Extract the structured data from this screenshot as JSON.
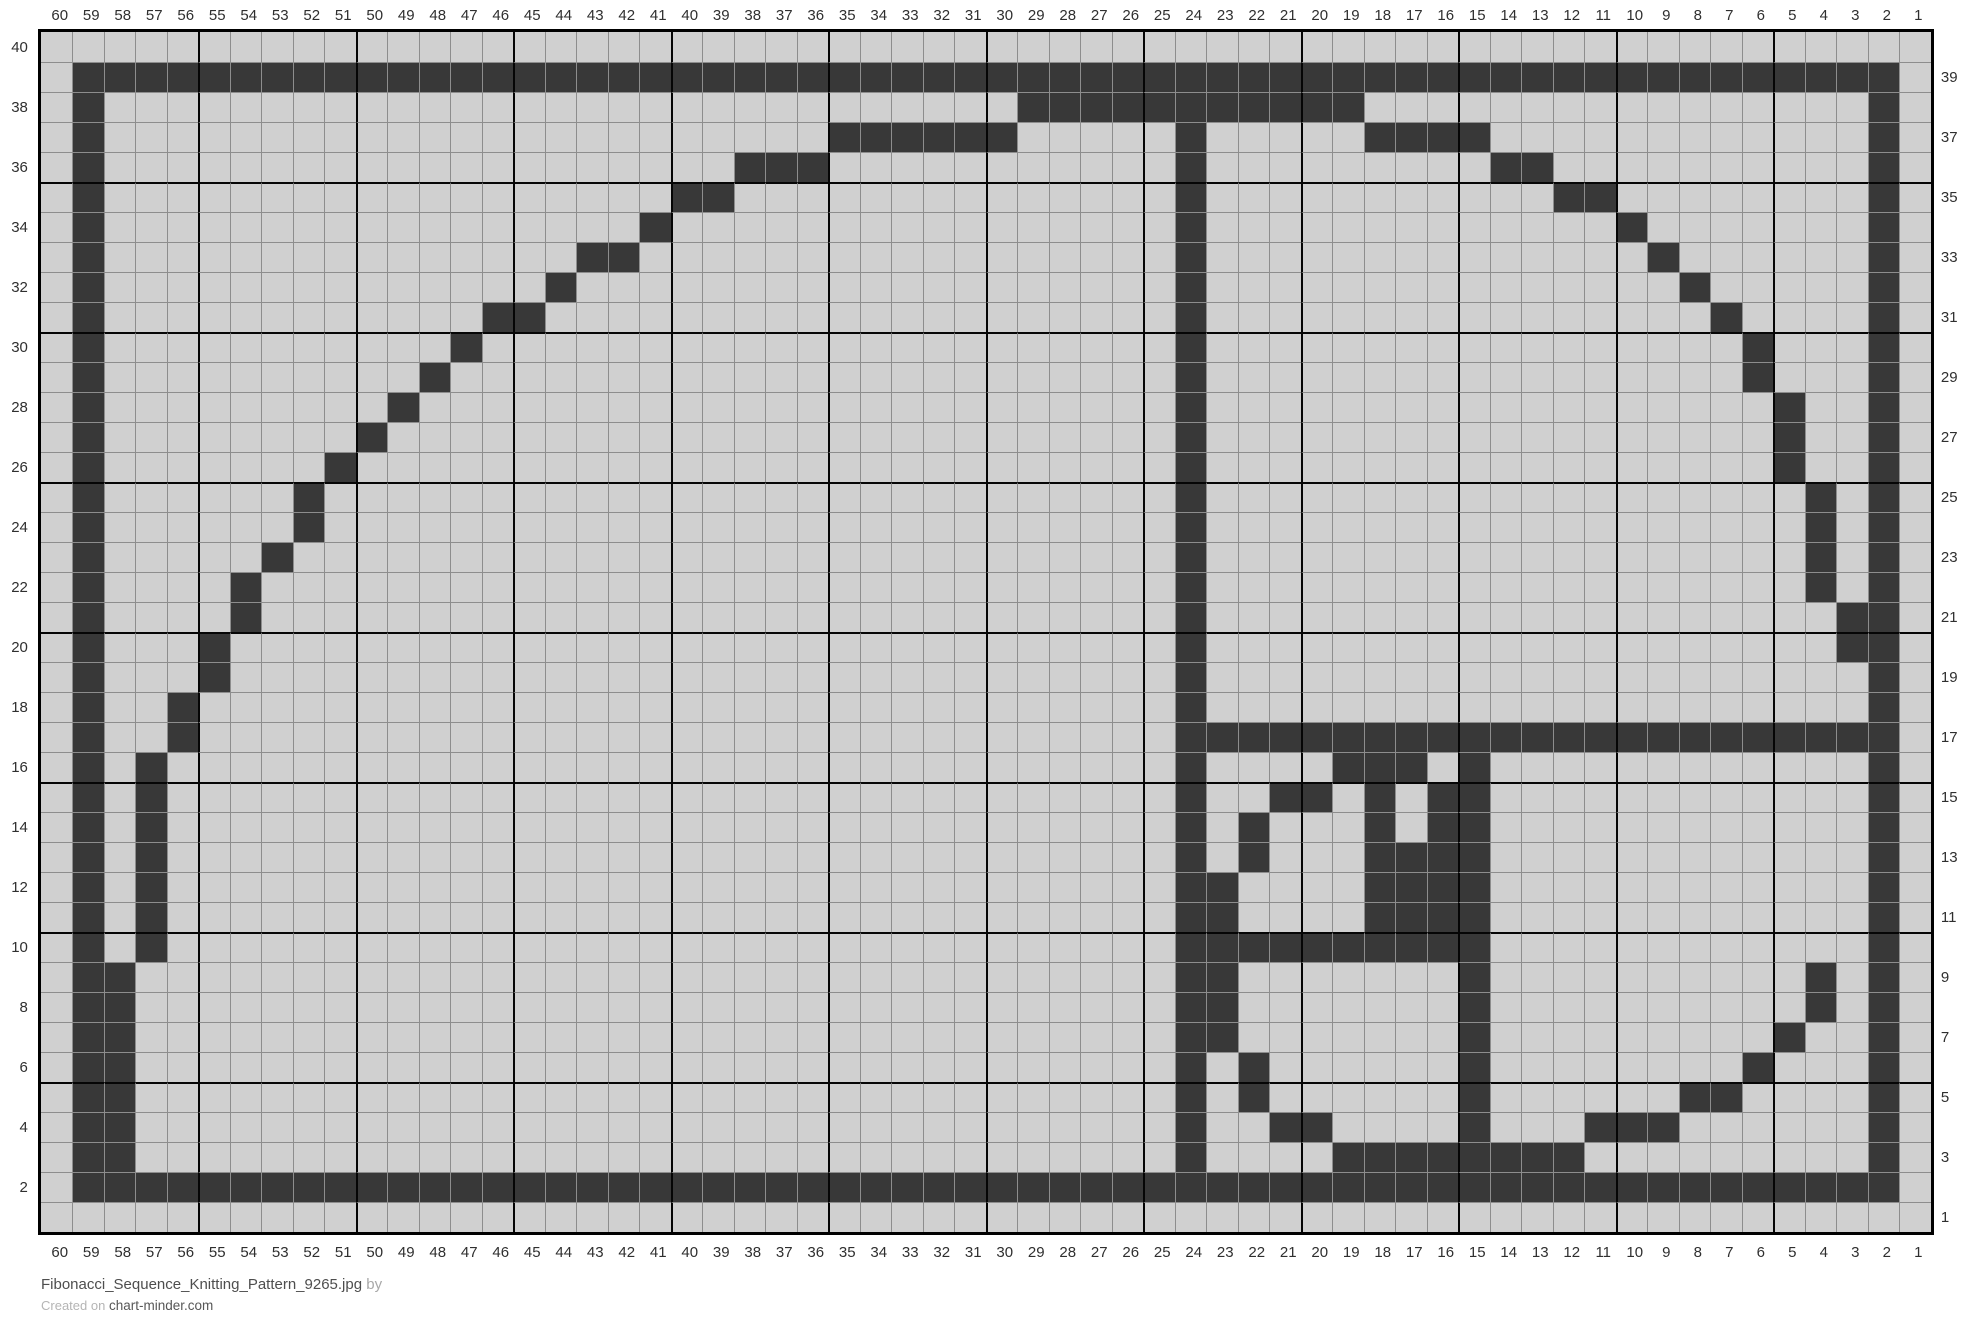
{
  "chart_data": {
    "type": "heatmap",
    "title": "Fibonacci golden-spiral knitting chart grid",
    "columns": 60,
    "rows_count": 40,
    "bold_line_every": 5,
    "legend": {
      "dark": "dark stitch",
      "light": "background stitch"
    },
    "colors": {
      "dark_cell": "#383838",
      "light_cell": "#d0d0d0",
      "thin_grid_line": "#8d8d8d",
      "bold_grid_line": "#050505",
      "outer_border": "#000000",
      "label_text": "#2f2f2f"
    },
    "top_labels": [
      60,
      59,
      58,
      57,
      56,
      55,
      54,
      53,
      52,
      51,
      50,
      49,
      48,
      47,
      46,
      45,
      44,
      43,
      42,
      41,
      40,
      39,
      38,
      37,
      36,
      35,
      34,
      33,
      32,
      31,
      30,
      29,
      28,
      27,
      26,
      25,
      24,
      23,
      22,
      21,
      20,
      19,
      18,
      17,
      16,
      15,
      14,
      13,
      12,
      11,
      10,
      9,
      8,
      7,
      6,
      5,
      4,
      3,
      2,
      1
    ],
    "bottom_labels": [
      60,
      59,
      58,
      57,
      56,
      55,
      54,
      53,
      52,
      51,
      50,
      49,
      48,
      47,
      46,
      45,
      44,
      43,
      42,
      41,
      40,
      39,
      38,
      37,
      36,
      35,
      34,
      33,
      32,
      31,
      30,
      29,
      28,
      27,
      26,
      25,
      24,
      23,
      22,
      21,
      20,
      19,
      18,
      17,
      16,
      15,
      14,
      13,
      12,
      11,
      10,
      9,
      8,
      7,
      6,
      5,
      4,
      3,
      2,
      1
    ],
    "left_labels": [
      40,
      38,
      36,
      34,
      32,
      30,
      28,
      26,
      24,
      22,
      20,
      18,
      16,
      14,
      12,
      10,
      8,
      6,
      4,
      2
    ],
    "right_labels": [
      39,
      37,
      35,
      33,
      31,
      29,
      27,
      25,
      23,
      21,
      19,
      17,
      15,
      13,
      11,
      9,
      7,
      5,
      3,
      1
    ],
    "rows": [
      {
        "row": 40,
        "dark": []
      },
      {
        "row": 39,
        "dark": [
          [
            59,
            2
          ]
        ]
      },
      {
        "row": 38,
        "dark": [
          [
            59,
            59
          ],
          [
            29,
            19
          ],
          [
            2,
            2
          ]
        ]
      },
      {
        "row": 37,
        "dark": [
          [
            59,
            59
          ],
          [
            35,
            30
          ],
          [
            24,
            24
          ],
          [
            18,
            15
          ],
          [
            2,
            2
          ]
        ]
      },
      {
        "row": 36,
        "dark": [
          [
            59,
            59
          ],
          [
            38,
            36
          ],
          [
            24,
            24
          ],
          [
            14,
            13
          ],
          [
            2,
            2
          ]
        ]
      },
      {
        "row": 35,
        "dark": [
          [
            59,
            59
          ],
          [
            40,
            39
          ],
          [
            24,
            24
          ],
          [
            12,
            11
          ],
          [
            2,
            2
          ]
        ]
      },
      {
        "row": 34,
        "dark": [
          [
            59,
            59
          ],
          [
            41,
            41
          ],
          [
            24,
            24
          ],
          [
            10,
            10
          ],
          [
            2,
            2
          ]
        ]
      },
      {
        "row": 33,
        "dark": [
          [
            59,
            59
          ],
          [
            43,
            42
          ],
          [
            24,
            24
          ],
          [
            9,
            9
          ],
          [
            2,
            2
          ]
        ]
      },
      {
        "row": 32,
        "dark": [
          [
            59,
            59
          ],
          [
            44,
            44
          ],
          [
            24,
            24
          ],
          [
            8,
            8
          ],
          [
            2,
            2
          ]
        ]
      },
      {
        "row": 31,
        "dark": [
          [
            59,
            59
          ],
          [
            46,
            45
          ],
          [
            24,
            24
          ],
          [
            7,
            7
          ],
          [
            2,
            2
          ]
        ]
      },
      {
        "row": 30,
        "dark": [
          [
            59,
            59
          ],
          [
            47,
            47
          ],
          [
            24,
            24
          ],
          [
            6,
            6
          ],
          [
            2,
            2
          ]
        ]
      },
      {
        "row": 29,
        "dark": [
          [
            59,
            59
          ],
          [
            48,
            48
          ],
          [
            24,
            24
          ],
          [
            6,
            6
          ],
          [
            2,
            2
          ]
        ]
      },
      {
        "row": 28,
        "dark": [
          [
            59,
            59
          ],
          [
            49,
            49
          ],
          [
            24,
            24
          ],
          [
            5,
            5
          ],
          [
            2,
            2
          ]
        ]
      },
      {
        "row": 27,
        "dark": [
          [
            59,
            59
          ],
          [
            50,
            50
          ],
          [
            24,
            24
          ],
          [
            5,
            5
          ],
          [
            2,
            2
          ]
        ]
      },
      {
        "row": 26,
        "dark": [
          [
            59,
            59
          ],
          [
            51,
            51
          ],
          [
            24,
            24
          ],
          [
            5,
            5
          ],
          [
            2,
            2
          ]
        ]
      },
      {
        "row": 25,
        "dark": [
          [
            59,
            59
          ],
          [
            52,
            52
          ],
          [
            24,
            24
          ],
          [
            4,
            4
          ],
          [
            2,
            2
          ]
        ]
      },
      {
        "row": 24,
        "dark": [
          [
            59,
            59
          ],
          [
            52,
            52
          ],
          [
            24,
            24
          ],
          [
            4,
            4
          ],
          [
            2,
            2
          ]
        ]
      },
      {
        "row": 23,
        "dark": [
          [
            59,
            59
          ],
          [
            53,
            53
          ],
          [
            24,
            24
          ],
          [
            4,
            4
          ],
          [
            2,
            2
          ]
        ]
      },
      {
        "row": 22,
        "dark": [
          [
            59,
            59
          ],
          [
            54,
            54
          ],
          [
            24,
            24
          ],
          [
            4,
            4
          ],
          [
            2,
            2
          ]
        ]
      },
      {
        "row": 21,
        "dark": [
          [
            59,
            59
          ],
          [
            54,
            54
          ],
          [
            24,
            24
          ],
          [
            3,
            2
          ]
        ]
      },
      {
        "row": 20,
        "dark": [
          [
            59,
            59
          ],
          [
            55,
            55
          ],
          [
            24,
            24
          ],
          [
            3,
            2
          ]
        ]
      },
      {
        "row": 19,
        "dark": [
          [
            59,
            59
          ],
          [
            55,
            55
          ],
          [
            24,
            24
          ],
          [
            2,
            2
          ]
        ]
      },
      {
        "row": 18,
        "dark": [
          [
            59,
            59
          ],
          [
            56,
            56
          ],
          [
            24,
            24
          ],
          [
            2,
            2
          ]
        ]
      },
      {
        "row": 17,
        "dark": [
          [
            59,
            59
          ],
          [
            56,
            56
          ],
          [
            24,
            2
          ]
        ]
      },
      {
        "row": 16,
        "dark": [
          [
            59,
            59
          ],
          [
            57,
            57
          ],
          [
            24,
            24
          ],
          [
            19,
            17
          ],
          [
            15,
            15
          ],
          [
            2,
            2
          ]
        ]
      },
      {
        "row": 15,
        "dark": [
          [
            59,
            59
          ],
          [
            57,
            57
          ],
          [
            24,
            24
          ],
          [
            21,
            20
          ],
          [
            18,
            18
          ],
          [
            16,
            15
          ],
          [
            2,
            2
          ]
        ]
      },
      {
        "row": 14,
        "dark": [
          [
            59,
            59
          ],
          [
            57,
            57
          ],
          [
            24,
            24
          ],
          [
            22,
            22
          ],
          [
            18,
            18
          ],
          [
            16,
            15
          ],
          [
            2,
            2
          ]
        ]
      },
      {
        "row": 13,
        "dark": [
          [
            59,
            59
          ],
          [
            57,
            57
          ],
          [
            24,
            24
          ],
          [
            22,
            22
          ],
          [
            18,
            15
          ],
          [
            2,
            2
          ]
        ]
      },
      {
        "row": 12,
        "dark": [
          [
            59,
            59
          ],
          [
            57,
            57
          ],
          [
            24,
            24
          ],
          [
            23,
            23
          ],
          [
            18,
            15
          ],
          [
            2,
            2
          ]
        ]
      },
      {
        "row": 11,
        "dark": [
          [
            59,
            59
          ],
          [
            57,
            57
          ],
          [
            24,
            24
          ],
          [
            23,
            23
          ],
          [
            18,
            15
          ],
          [
            2,
            2
          ]
        ]
      },
      {
        "row": 10,
        "dark": [
          [
            59,
            59
          ],
          [
            57,
            57
          ],
          [
            24,
            15
          ],
          [
            2,
            2
          ]
        ]
      },
      {
        "row": 9,
        "dark": [
          [
            59,
            58
          ],
          [
            24,
            23
          ],
          [
            15,
            15
          ],
          [
            4,
            4
          ],
          [
            2,
            2
          ]
        ]
      },
      {
        "row": 8,
        "dark": [
          [
            59,
            58
          ],
          [
            24,
            23
          ],
          [
            15,
            15
          ],
          [
            4,
            4
          ],
          [
            2,
            2
          ]
        ]
      },
      {
        "row": 7,
        "dark": [
          [
            59,
            58
          ],
          [
            24,
            23
          ],
          [
            15,
            15
          ],
          [
            5,
            5
          ],
          [
            2,
            2
          ]
        ]
      },
      {
        "row": 6,
        "dark": [
          [
            59,
            58
          ],
          [
            24,
            24
          ],
          [
            22,
            22
          ],
          [
            15,
            15
          ],
          [
            6,
            6
          ],
          [
            2,
            2
          ]
        ]
      },
      {
        "row": 5,
        "dark": [
          [
            59,
            58
          ],
          [
            24,
            24
          ],
          [
            22,
            22
          ],
          [
            15,
            15
          ],
          [
            8,
            7
          ],
          [
            2,
            2
          ]
        ]
      },
      {
        "row": 4,
        "dark": [
          [
            59,
            58
          ],
          [
            24,
            24
          ],
          [
            21,
            20
          ],
          [
            15,
            15
          ],
          [
            11,
            9
          ],
          [
            2,
            2
          ]
        ]
      },
      {
        "row": 3,
        "dark": [
          [
            59,
            58
          ],
          [
            24,
            24
          ],
          [
            19,
            12
          ],
          [
            2,
            2
          ]
        ]
      },
      {
        "row": 2,
        "dark": [
          [
            59,
            2
          ]
        ]
      },
      {
        "row": 1,
        "dark": []
      }
    ]
  },
  "footer": {
    "filename": "Fibonacci_Sequence_Knitting_Pattern_9265.jpg",
    "byline": "by",
    "created_prefix": "Created on",
    "site_name": "chart-minder.com"
  }
}
